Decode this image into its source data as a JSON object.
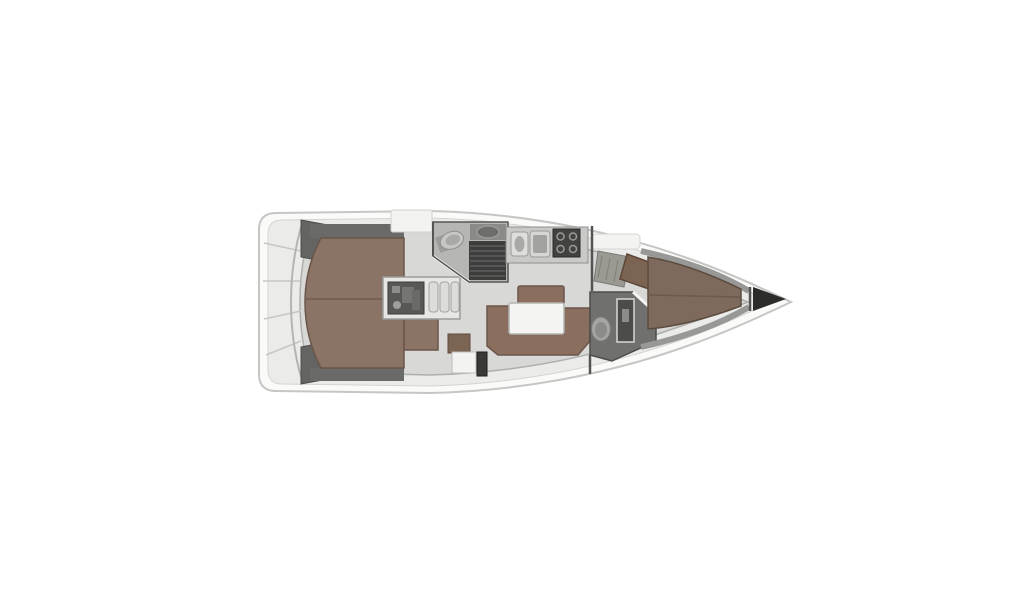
{
  "diagram": {
    "type": "yacht-interior-floorplan",
    "orientation": "bow-right",
    "regions": [
      "stern-transom",
      "cockpit-locker-port",
      "cockpit-locker-starboard",
      "aft-cabin-double-berth",
      "engine-compartment",
      "companionway-steps",
      "aft-head",
      "galley",
      "salon-settee",
      "salon-table",
      "nav-station",
      "forward-head",
      "forward-v-berth",
      "anchor-locker"
    ]
  },
  "colors": {
    "background": "#ffffff",
    "hull_fill": "#fafaf9",
    "hull_outline": "#c6c6c4",
    "deck": "#ebebe9",
    "sole": "#d8d8d6",
    "sole_line": "#aeaeac",
    "dark_gray": "#646462",
    "headboard_gray": "#6a6a68",
    "berth_aft": "#8b7365",
    "berth_fwd": "#7e6a5c",
    "settee": "#8a6f5e",
    "wood_trim": "#6b564a",
    "seam_brown": "#6e5c50",
    "table_top": "#f4f4f2",
    "white_fixture": "#f3f3f1",
    "engine_dark": "#585856",
    "steps_gray": "#dcdcda",
    "head_floor": "#b6b6b4",
    "shower_grate": "#3d3d3b",
    "counter_gray": "#c9c9c7",
    "sink_gray": "#d6d6d4",
    "basin_gray": "#a2a2a0",
    "stove_dark": "#424240",
    "fwd_head_floor": "#70706e",
    "shower_column": "#4c4c4a",
    "toilet_gray": "#c6c6c4",
    "chart_table": "#7c6452",
    "louver_gray": "#9a9a92",
    "heater_dark": "#393937",
    "shelf_gray": "#989896",
    "bulkhead_dark": "#545452",
    "anchor_locker": "#2c2c2a",
    "door_white": "#f4f4f2"
  }
}
